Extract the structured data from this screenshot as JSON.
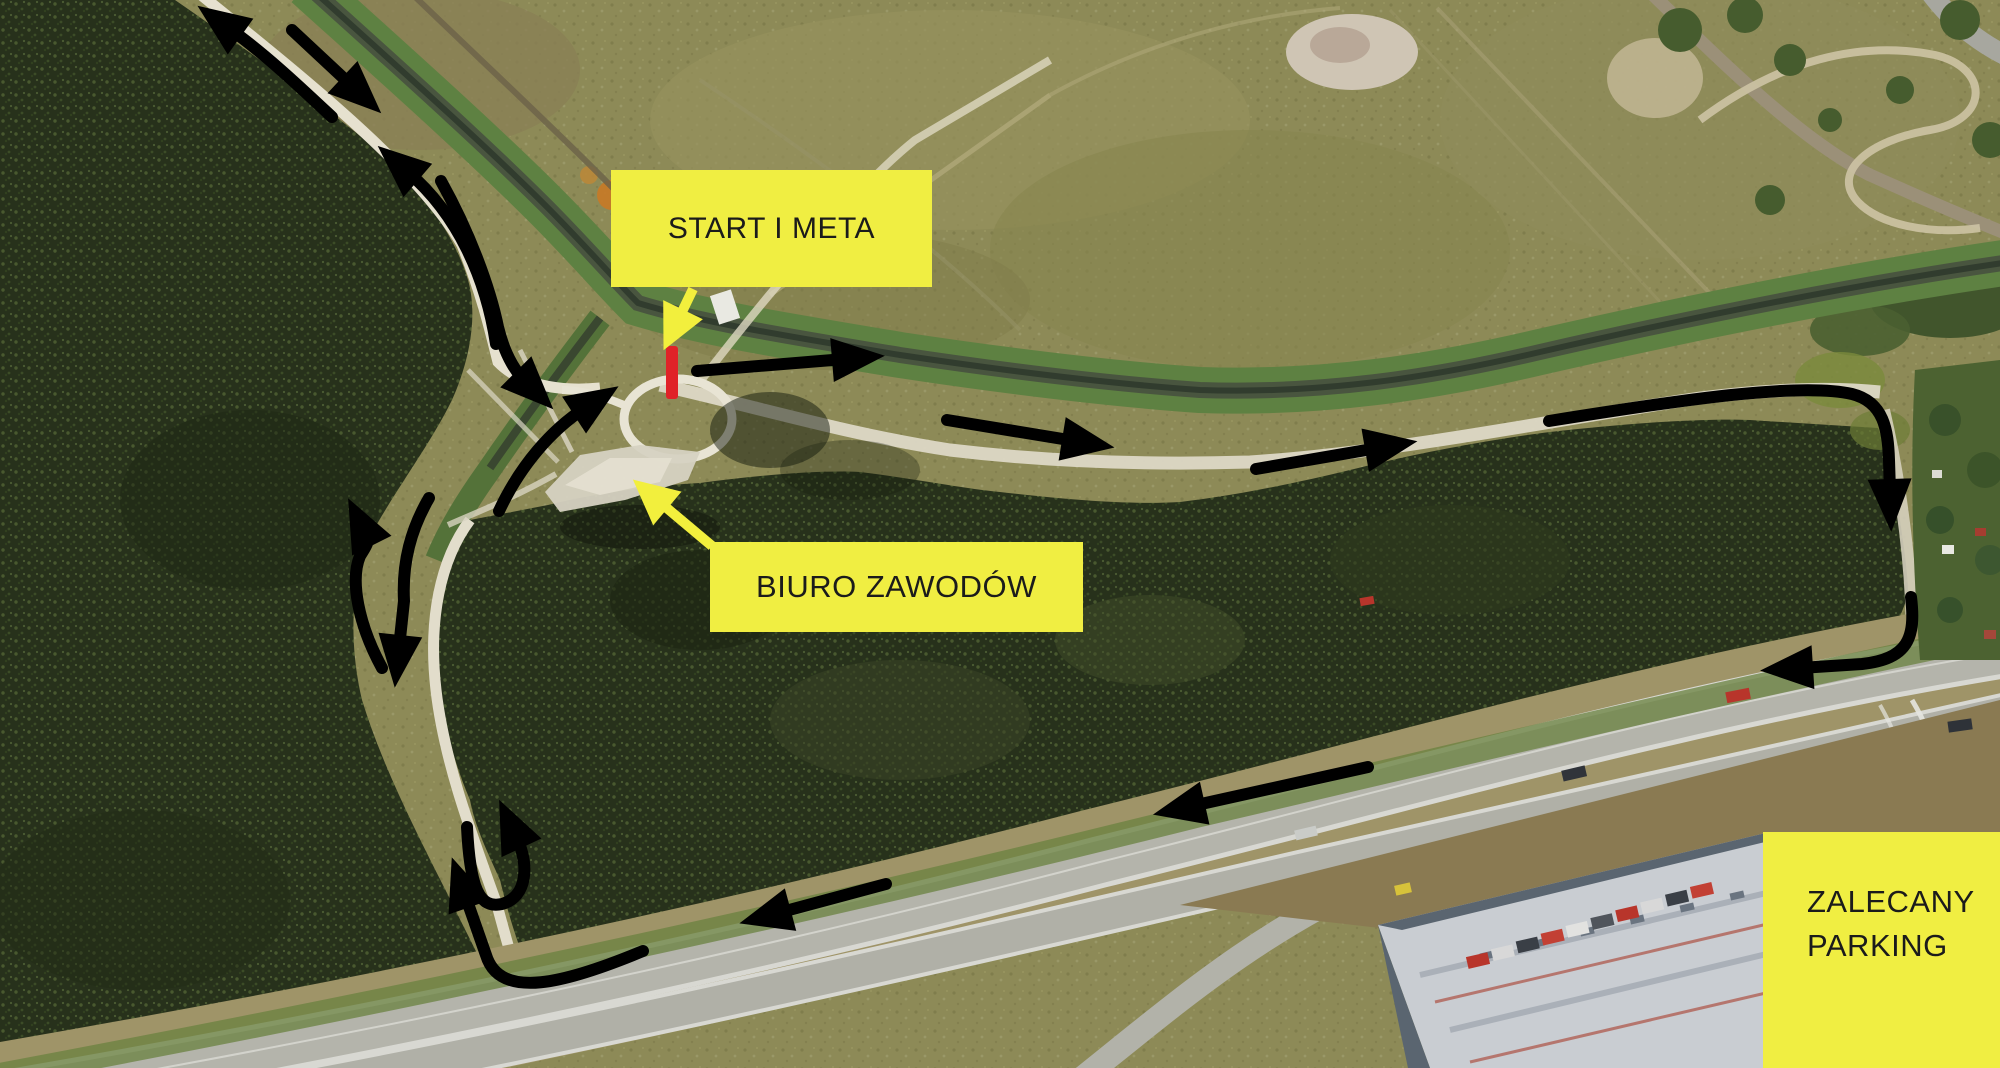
{
  "labels": {
    "start_meta": {
      "text": "START I META"
    },
    "biuro": {
      "text": "BIURO ZAWODÓW"
    },
    "parking": {
      "line1": "ZALECANY",
      "line2": "PARKING"
    }
  },
  "colors": {
    "label_bg": "#F0EE42",
    "label_text": "#1B1B1B",
    "course": "#000000",
    "start_line": "#E02228",
    "callout_arrow": "#F2EF3D"
  }
}
